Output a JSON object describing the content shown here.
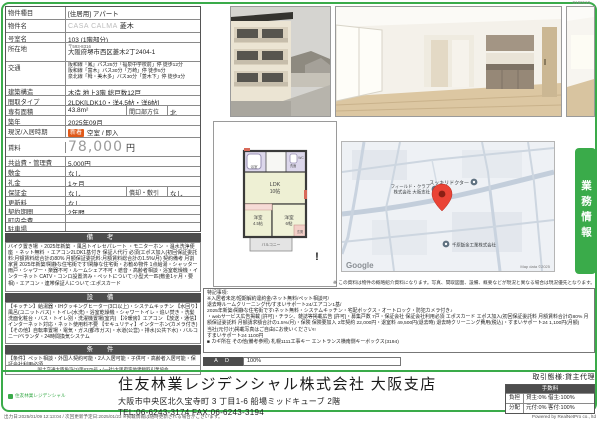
{
  "colors": {
    "accent_green": "#3aab4a",
    "badge_orange": "#e05a1a",
    "header_dark": "#4d4d4d",
    "pin_red": "#ea4335",
    "rent_gray": "#9b9b9b"
  },
  "page": {
    "doc_id": "0190110",
    "footer_left": "出力日:2025/01/09 12:13:04 / 次回更新予定日:2025/01/23 ※掲載情報は随時更新される場合がございます。",
    "footer_right": "Powered by RealNetPro co., ltd"
  },
  "pt": {
    "type_l": "物件種目",
    "type_v": "[住居用] アパート",
    "name_l": "物件名",
    "name_gray": "CASA CALMA",
    "name_v": "菱木",
    "room_l": "号室名",
    "room_v": "103 (1階部分)",
    "addr_l": "所在地",
    "postal": "〒593-8316",
    "addr_v": "大阪府堺市西区菱木2丁2404-1",
    "access_l": "交通",
    "access_1": "阪和線「鳳」バス25分「福泉中学校前」停 徒歩12分",
    "access_2": "阪和線「富木」バス30分「万崎」停 徒歩5分",
    "access_3": "泉北線「栂・美木多」バス30分「菱木下」停 徒歩3分",
    "struct_l": "建築構造",
    "struct_v": "木造 地上3階 総戸数12戸",
    "layout_l": "間取タイプ",
    "layout_v": "2LDK[LDK10・洋4.5帖・洋6帖]",
    "area_l": "専有面積",
    "area_v": "43.8m²",
    "facing_l": "間口部方位",
    "facing_v": "北",
    "built_l": "築年",
    "built_v": "2025年09月",
    "status_l": "現況/入居時期",
    "status_badge": "新着",
    "status_v": "空室 / 即入",
    "rent_l": "賃料",
    "rent_v": "78,000",
    "rent_u": "円",
    "mfee_l": "共益費・管理費",
    "mfee_v": "5,000円",
    "deposit_l": "敷金",
    "deposit_v": "なし",
    "key_l": "礼金",
    "key_v": "1ヶ月",
    "guar_l": "保証金",
    "guar_v": "なし",
    "amort_l": "償却・敷引",
    "amort_v": "なし",
    "renew_l": "更新料",
    "renew_v": "なし",
    "term_l": "契約期間",
    "term_v": "2年間",
    "town_l": "町内会費",
    "town_v": "",
    "park_l": "駐車場",
    "park_v": ""
  },
  "remarks": {
    "title": "備 考",
    "text": "バイク置き場 ・2025年新築 ・風呂トイレセパレート ・モニターホン ・温水洗浄便座 ・ネット無料 ・エアコン2LDK1基付き 保証人代行 必須(エポス加入(初回保証委託料:月額賃料総合計の80% 月額保証委託料:月額賃料総合計の1.5%/月) 契約備考 月割家賃 2025年新築!閑静な住宅街です!閑静な住宅街・お勧め物件 1点給湯・シャッター雨戸・シャワー・楽器不可・ルームシェア不可・遮音・高齢者相談・浴室乾燥機・インターネット CATV・コンロ設置済み・ペットについて:小型犬一匹(敷金1ヶ月・要相)・エアコン・連帯保証人について:エポスカード"
  },
  "facil": {
    "title": "設 備",
    "text": "【キッチン】給湯器・IHクッキングヒーター(3口以上)・システムキッチン 【水回り】風呂(ユニットバス)・トイレ(水洗)・浴室乾燥機・シャワートイレ・追い焚き・洗髪洗面化粧台・バス・トイレ別・洗濯機置場(室内) 【冷暖房】エアコン 【放送・通信】インターネット対応・ネット使用料不要 【セキュリティ】インターホン(カメラ付き) 【その他】自転車置場・電気・ガス(都市ガス)・水道(公営)・排水(公共下水)・バルコニー/ベランダ・24時間換気システム"
  },
  "cond": {
    "title": "条 件",
    "text": "【条件】ペット相談・外国人契約可能・2人入居可能・子供可・高齢者入居可能・保証会社利用必須",
    "license": "国土交通大臣免許(3)第8375号・(一社)大阪府宅地建物取引業協会"
  },
  "fp": {
    "ldk1": "LDK",
    "ldk2": "10帖",
    "r1a": "洋室",
    "r1b": "4.5帖",
    "r2a": "洋室",
    "r2b": "6帖",
    "balcony": "バルコニー",
    "genkan": "玄関",
    "bath": "浴室",
    "wash": "洗面",
    "wc": "WC",
    "alert": "!"
  },
  "map": {
    "poi1": "スッキリドクター",
    "poi2a": "フィールド・クラブ",
    "poi2b": "株式会社 大阪支社",
    "poi3": "千原鈑金工業株式会社",
    "google": "Google",
    "copyright": "Map data ©2025"
  },
  "note": "※ この資料は物件の概略紹介資料になります。写真、間取図面、設備、概要などが現況と異なる場合は現況優先となります。",
  "tab": "業務情報",
  "sn": {
    "lines": [
      "特記事項:",
      "※入居者未定/短期解約違約金/ネット無料/ペット相談可/",
      "退去時ルームクリーニング代/すまいサポート24/エアコン1基/",
      "2025年新築!閑静な住宅街です!ネット無料・システムキッチン・宅配ボックス・オートロック・防犯カメラ付き♪",
      "・webサービス広告掲載 [許可]・チラシ、雑誌等掲載広告 [許可]・募集戸数 7戸・保証会社 保証会社利用必須 エポスカード エポス加入(初回保証委託料 月額賃料合計の80% 月額保証委託料 月額請求額合計の1.5%/月)・保険 保険要加入 2年契約 22,000円・退室料 49,500円(退去時) 退去時クリーニング費用(税込)・すまいサポート24 1,100円(月額)",
      "当社(元付け)掲載写真はご自由にお使いください!!",
      "すまいサポート24 1100円",
      "■ カギ所在 その他(備考参照) 札幌1111工事キー エントランス横南側キーボックス(3194)"
    ]
  },
  "ad": {
    "label": "A D",
    "value": "100%"
  },
  "company": {
    "logo": "住友林業レジデンシャル",
    "name": "住友林業レジデンシャル株式会社 大阪支店",
    "address": "大阪市中央区北久宝寺町 3 丁目1-6 船場ミッドキューブ 2階",
    "tel": "TEL:06-6243-3174 FAX:06-6243-3194"
  },
  "deal": {
    "label": "取引態様:貸主代理",
    "fee_header": "手数料",
    "rows": [
      {
        "l": "負担",
        "v": "貸主:0% 借主:100%"
      },
      {
        "l": "分配",
        "v": "元付:0% 客付:100%"
      }
    ]
  }
}
